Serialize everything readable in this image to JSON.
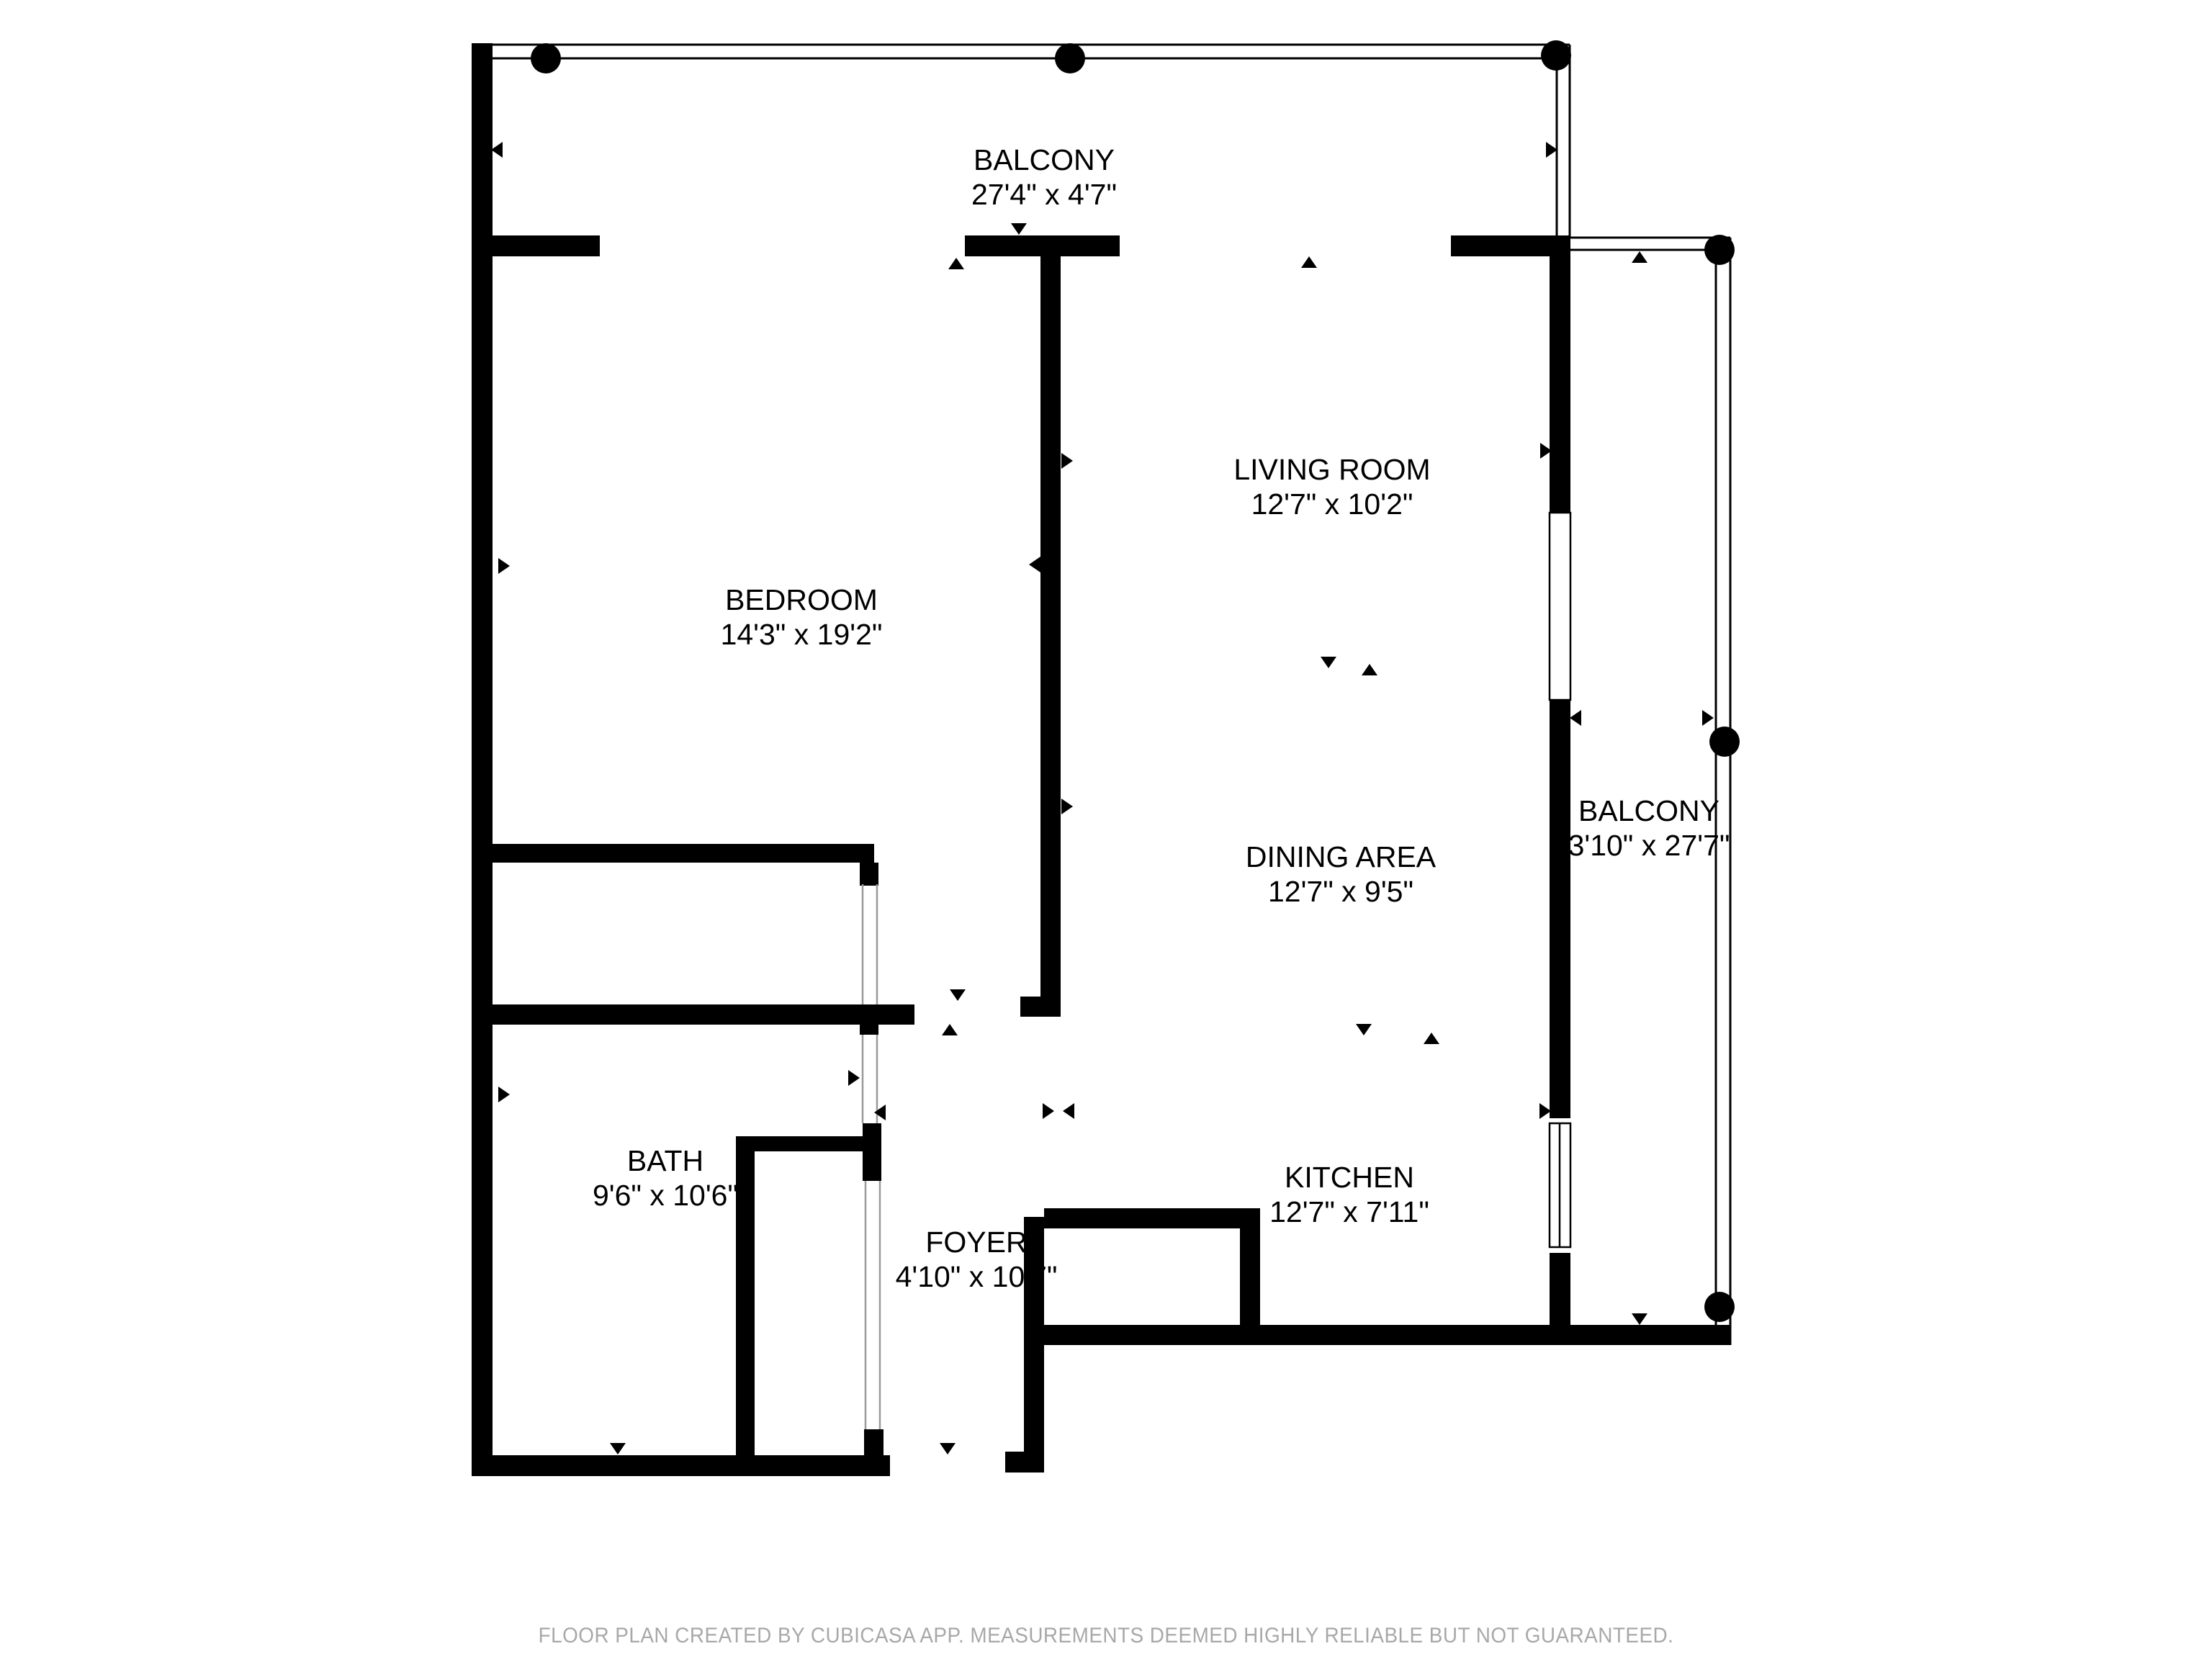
{
  "rooms": {
    "balcony_top": {
      "name": "BALCONY",
      "dimensions": "27'4\" x 4'7\""
    },
    "living_room": {
      "name": "LIVING ROOM",
      "dimensions": "12'7\" x 10'2\""
    },
    "bedroom": {
      "name": "BEDROOM",
      "dimensions": "14'3\" x 19'2\""
    },
    "balcony_right": {
      "name": "BALCONY",
      "dimensions": "3'10\" x 27'7\""
    },
    "dining_area": {
      "name": "DINING AREA",
      "dimensions": "12'7\" x 9'5\""
    },
    "bath": {
      "name": "BATH",
      "dimensions": "9'6\" x 10'6\""
    },
    "kitchen": {
      "name": "KITCHEN",
      "dimensions": "12'7\" x 7'11\""
    },
    "foyer": {
      "name": "FOYER",
      "dimensions": "4'10\" x 10'7\""
    }
  },
  "footer": {
    "disclaimer": "FLOOR PLAN CREATED BY CUBICASA APP. MEASUREMENTS DEEMED HIGHLY RELIABLE BUT NOT GUARANTEED."
  },
  "colors": {
    "wall": "#000000",
    "label_text": "#000000",
    "footer_text": "#a8a8a8",
    "door_jamb": "#9a9a9a",
    "background": "#ffffff"
  }
}
